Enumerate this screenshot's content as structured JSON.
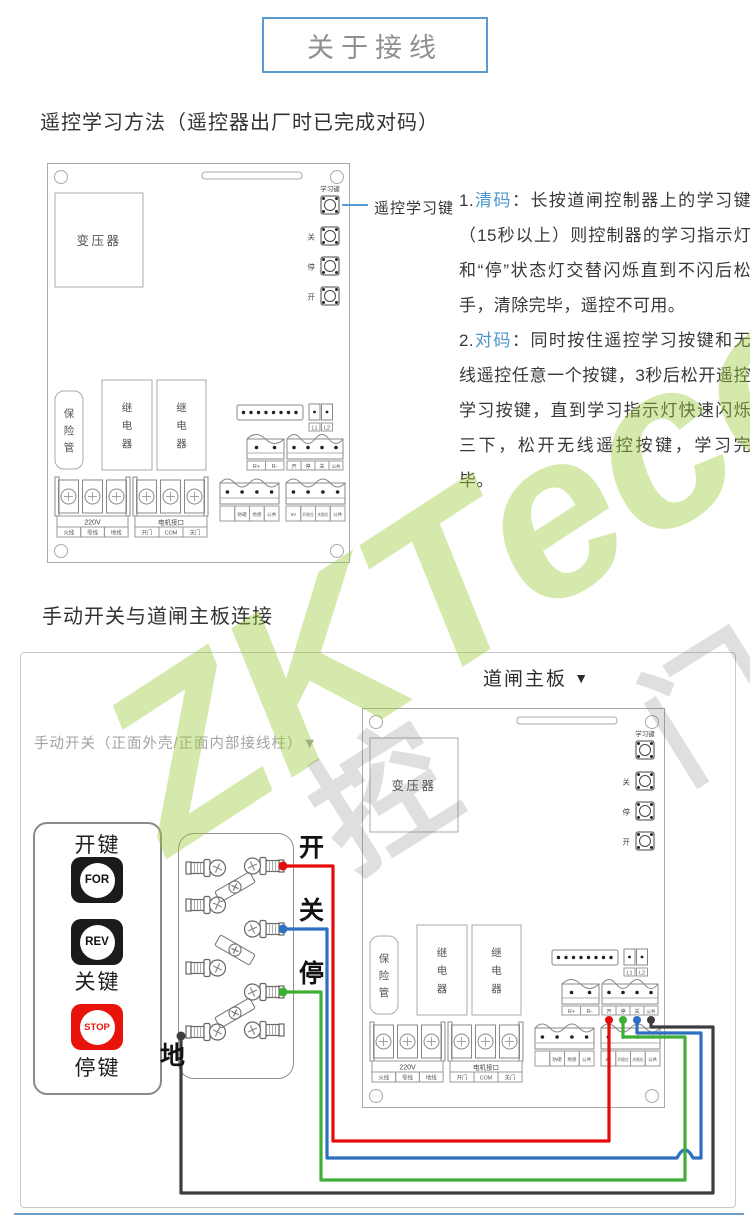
{
  "title": "关于接线",
  "section1": {
    "heading": "遥控学习方法（遥控器出厂时已完成对码）",
    "callout_label": "遥控学习键",
    "instructions": [
      {
        "num": "1.",
        "term": "清码",
        "body": "：长按道闸控制器上的学习键（15秒以上）则控制器的学习指示灯和“停”状态灯交替闪烁直到不闪后松手，清除完毕，遥控不可用。"
      },
      {
        "num": "2.",
        "term": "对码",
        "body": "：同时按住遥控学习按键和无线遥控任意一个按键，3秒后松开遥控学习按键，直到学习指示灯快速闪烁三下，松开无线遥控按键，学习完毕。"
      }
    ]
  },
  "section2": {
    "heading": "手动开关与道闸主板连接",
    "board_caption": "道闸主板",
    "board_caption_arrow": "▼",
    "switch_note": "手动开关（正面外壳/正面内部接线柱）",
    "switch_note_arrow": "▼",
    "switch_panel": {
      "open_key": "开键",
      "for_btn": "FOR",
      "rev_btn": "REV",
      "close_key": "关键",
      "stop_btn": "STOP",
      "stop_key": "停键"
    },
    "wire_labels": {
      "open": "开",
      "close": "关",
      "stop": "停",
      "ground": "地"
    },
    "wire_colors": {
      "open": "#e60a0a",
      "close": "#2f6fc1",
      "stop": "#3fae37",
      "ground": "#3d3d3d"
    }
  },
  "board": {
    "transformer": "变压器",
    "learn_key": "学习键",
    "btn_close": "关",
    "btn_stop": "停",
    "btn_open": "开",
    "fuse_chars": [
      "保",
      "险",
      "管"
    ],
    "relay_chars": [
      "继",
      "电",
      "器"
    ],
    "l1": "L1",
    "l2": "L2",
    "r_plus": "R+",
    "r_minus": "R-",
    "io4": [
      "开",
      "停",
      "关",
      "公共"
    ],
    "power_label": "220V",
    "power_cells": [
      "火线",
      "零线",
      "地线"
    ],
    "motor_label": "电机接口",
    "motor_cells": [
      "开门",
      "COM",
      "关门"
    ],
    "sensor_cells": [
      "防砸",
      "地感",
      "公共"
    ],
    "limit_cells": [
      "5V",
      "开限位",
      "关限位",
      "公共"
    ]
  },
  "watermark": {
    "brand": "ZKTeco",
    "char1": "门",
    "char2": "控"
  }
}
